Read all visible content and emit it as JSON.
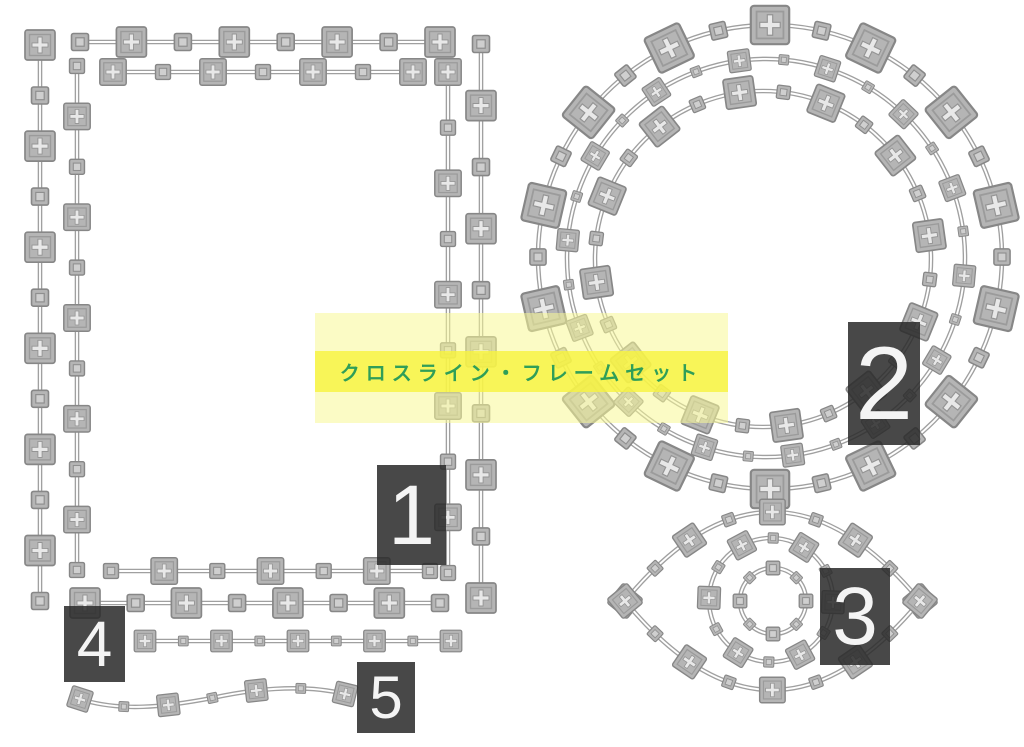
{
  "title_banner": {
    "text": "クロスライン・フレームセット",
    "outer_band_color": "#f8f896",
    "inner_band_color": "#f8f43c",
    "text_color": "#2f9e58"
  },
  "palette": {
    "background": "#ffffff",
    "line_color": "#a0a0a0",
    "ornament_fill": "#b5b5b5",
    "ornament_stroke": "#878787",
    "ornament_inner_cross": "#e8e8e8",
    "label_bg": "#2a2a2a",
    "label_fg": "#f4f4f4"
  },
  "ornaments": {
    "large": "cross-pane-square-ornament",
    "small": "plain-square-ornament"
  },
  "items": [
    {
      "number": "1",
      "name": "rectangle-double-frame"
    },
    {
      "number": "2",
      "name": "triple-circle-frame"
    },
    {
      "number": "3",
      "name": "eye-shaped-frame"
    },
    {
      "number": "4",
      "name": "straight-line-border"
    },
    {
      "number": "5",
      "name": "wavy-line-border"
    }
  ]
}
